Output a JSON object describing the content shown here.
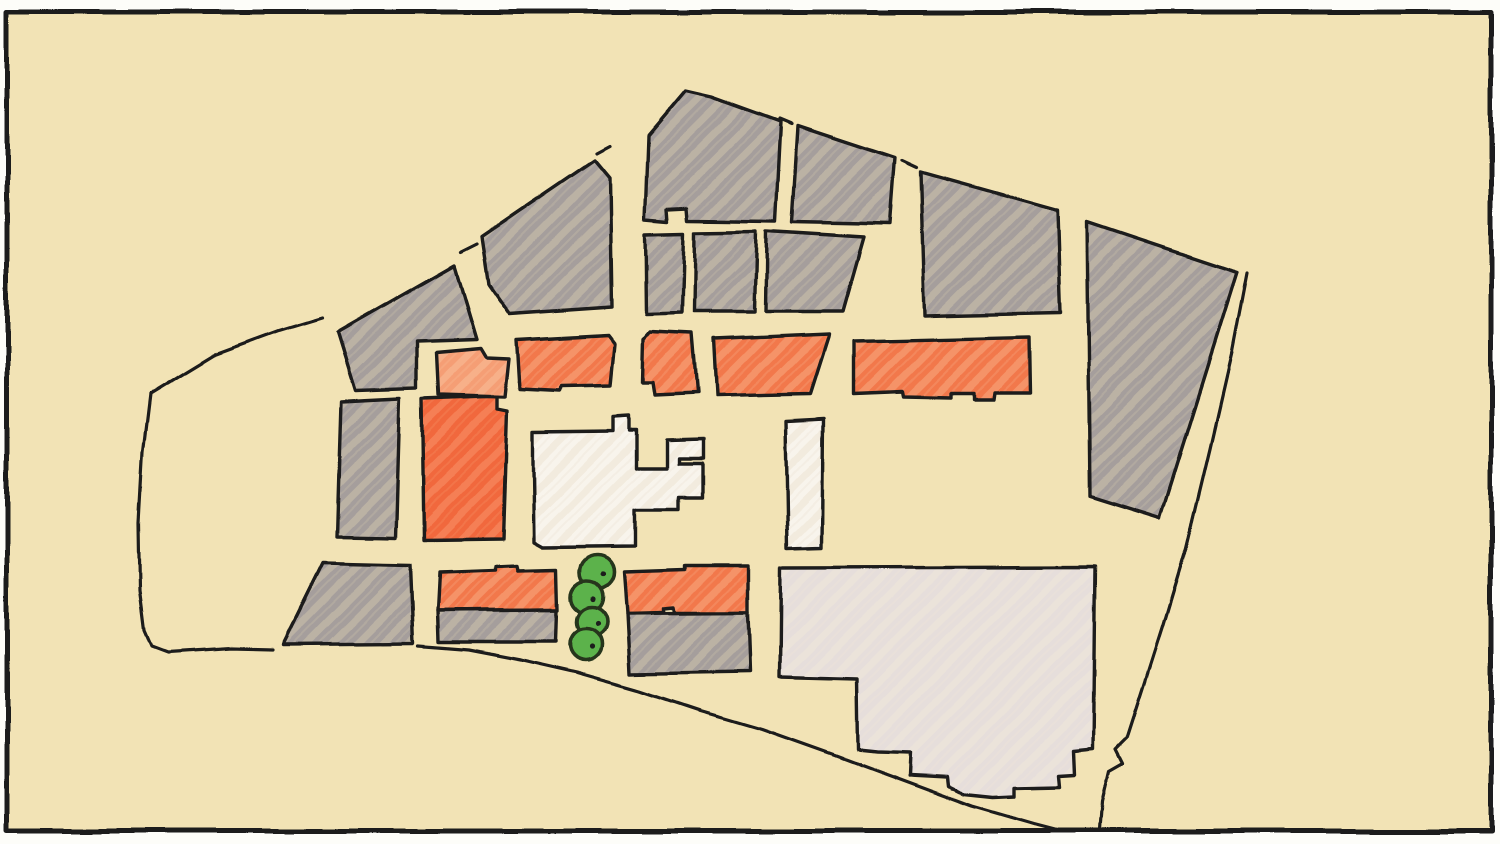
{
  "canvas": {
    "width": 1500,
    "height": 844,
    "frame": {
      "x": 7,
      "y": 12,
      "width": 1484,
      "height": 819
    }
  },
  "palette": {
    "paper": "#fdfdf9",
    "canvas_fill": "#f2e3b5",
    "ink": "#1d1c1a",
    "tree_outline": "#26351d",
    "fills": {
      "gray": {
        "base": "#a59e9c",
        "streak": "#cdc3ab"
      },
      "orange": {
        "base": "#f2784c",
        "streak": "#f8a97e"
      },
      "orange_light": {
        "base": "#f59e74",
        "streak": "#f9bf9a"
      },
      "orange_strong": {
        "base": "#f1673c",
        "streak": "#f79468"
      },
      "white": {
        "base": "#f8f4ec",
        "streak": "#ece4d2"
      },
      "lavender": {
        "base": "#e6dedb",
        "streak": "#efe7d9"
      },
      "tree": {
        "base": "#5cb24b",
        "streak": "#5cb24b"
      }
    }
  },
  "map": {
    "blocks": [
      {
        "name": "gray-block-west-upper",
        "category": "gray",
        "points": [
          [
            338,
            332
          ],
          [
            455,
            265
          ],
          [
            477,
            339
          ],
          [
            416,
            341
          ],
          [
            416,
            388
          ],
          [
            356,
            390
          ]
        ]
      },
      {
        "name": "gray-block-northwest",
        "category": "gray",
        "points": [
          [
            482,
            237
          ],
          [
            595,
            160
          ],
          [
            610,
            178
          ],
          [
            612,
            307
          ],
          [
            510,
            314
          ],
          [
            489,
            284
          ]
        ]
      },
      {
        "name": "gray-block-north-peak",
        "category": "gray",
        "points": [
          [
            648,
            136
          ],
          [
            686,
            91
          ],
          [
            712,
            97
          ],
          [
            781,
            122
          ],
          [
            776,
            221
          ],
          [
            688,
            220
          ],
          [
            687,
            208
          ],
          [
            667,
            209
          ],
          [
            668,
            221
          ],
          [
            645,
            219
          ]
        ]
      },
      {
        "name": "gray-block-north-mid",
        "category": "gray",
        "points": [
          [
            798,
            126
          ],
          [
            895,
            158
          ],
          [
            890,
            224
          ],
          [
            792,
            222
          ]
        ]
      },
      {
        "name": "gray-block-northeast",
        "category": "gray",
        "points": [
          [
            921,
            172
          ],
          [
            1057,
            210
          ],
          [
            1060,
            313
          ],
          [
            925,
            316
          ]
        ]
      },
      {
        "name": "gray-block-row2-a",
        "category": "gray",
        "points": [
          [
            645,
            234
          ],
          [
            684,
            233
          ],
          [
            682,
            313
          ],
          [
            646,
            314
          ]
        ]
      },
      {
        "name": "gray-block-row2-b",
        "category": "gray",
        "points": [
          [
            695,
            232
          ],
          [
            757,
            231
          ],
          [
            755,
            312
          ],
          [
            694,
            312
          ]
        ]
      },
      {
        "name": "gray-block-row2-c",
        "category": "gray",
        "points": [
          [
            767,
            231
          ],
          [
            864,
            237
          ],
          [
            843,
            311
          ],
          [
            766,
            311
          ]
        ]
      },
      {
        "name": "gray-block-east-wedge",
        "category": "gray",
        "points": [
          [
            1087,
            222
          ],
          [
            1237,
            272
          ],
          [
            1160,
            518
          ],
          [
            1090,
            496
          ]
        ]
      },
      {
        "name": "gray-strip-mid-west",
        "category": "gray",
        "points": [
          [
            341,
            401
          ],
          [
            400,
            398
          ],
          [
            396,
            537
          ],
          [
            337,
            536
          ]
        ]
      },
      {
        "name": "orange-tower-mid-west",
        "category": "orange_strong",
        "points": [
          [
            422,
            399
          ],
          [
            497,
            396
          ],
          [
            497,
            409
          ],
          [
            507,
            411
          ],
          [
            503,
            539
          ],
          [
            424,
            540
          ]
        ]
      },
      {
        "name": "orange-block-row1-1",
        "category": "orange_light",
        "points": [
          [
            436,
            352
          ],
          [
            481,
            348
          ],
          [
            487,
            358
          ],
          [
            509,
            359
          ],
          [
            505,
            397
          ],
          [
            438,
            395
          ]
        ]
      },
      {
        "name": "orange-block-row1-2",
        "category": "orange",
        "points": [
          [
            517,
            340
          ],
          [
            608,
            335
          ],
          [
            615,
            344
          ],
          [
            611,
            385
          ],
          [
            562,
            386
          ],
          [
            560,
            391
          ],
          [
            520,
            389
          ]
        ]
      },
      {
        "name": "orange-block-row1-3",
        "category": "orange",
        "points": [
          [
            644,
            339
          ],
          [
            650,
            332
          ],
          [
            692,
            334
          ],
          [
            697,
            393
          ],
          [
            655,
            395
          ],
          [
            653,
            382
          ],
          [
            643,
            382
          ]
        ]
      },
      {
        "name": "orange-block-row1-4",
        "category": "orange",
        "points": [
          [
            713,
            339
          ],
          [
            829,
            334
          ],
          [
            810,
            394
          ],
          [
            716,
            396
          ]
        ]
      },
      {
        "name": "orange-block-row1-5",
        "category": "orange",
        "points": [
          [
            854,
            341
          ],
          [
            1029,
            337
          ],
          [
            1030,
            393
          ],
          [
            994,
            393
          ],
          [
            993,
            400
          ],
          [
            973,
            400
          ],
          [
            973,
            394
          ],
          [
            950,
            394
          ],
          [
            950,
            398
          ],
          [
            903,
            397
          ],
          [
            902,
            392
          ],
          [
            854,
            394
          ]
        ]
      },
      {
        "name": "white-building-main",
        "category": "white",
        "points": [
          [
            533,
            432
          ],
          [
            613,
            431
          ],
          [
            613,
            417
          ],
          [
            629,
            416
          ],
          [
            629,
            431
          ],
          [
            636,
            431
          ],
          [
            636,
            468
          ],
          [
            667,
            468
          ],
          [
            667,
            440
          ],
          [
            703,
            439
          ],
          [
            703,
            458
          ],
          [
            679,
            458
          ],
          [
            679,
            463
          ],
          [
            702,
            463
          ],
          [
            702,
            498
          ],
          [
            678,
            498
          ],
          [
            678,
            510
          ],
          [
            635,
            510
          ],
          [
            635,
            546
          ],
          [
            543,
            547
          ],
          [
            534,
            542
          ],
          [
            533,
            470
          ]
        ]
      },
      {
        "name": "white-building-bar",
        "category": "white",
        "points": [
          [
            786,
            421
          ],
          [
            823,
            419
          ],
          [
            822,
            547
          ],
          [
            788,
            548
          ]
        ]
      },
      {
        "name": "gray-block-southwest",
        "category": "gray",
        "points": [
          [
            323,
            563
          ],
          [
            410,
            565
          ],
          [
            413,
            643
          ],
          [
            283,
            644
          ]
        ]
      },
      {
        "name": "orange-block-south-a",
        "category": "orange",
        "points": [
          [
            439,
            573
          ],
          [
            496,
            571
          ],
          [
            496,
            567
          ],
          [
            517,
            566
          ],
          [
            518,
            571
          ],
          [
            557,
            570
          ],
          [
            558,
            610
          ],
          [
            437,
            611
          ]
        ]
      },
      {
        "name": "gray-base-south-a",
        "category": "gray",
        "points": [
          [
            437,
            611
          ],
          [
            557,
            610
          ],
          [
            556,
            642
          ],
          [
            438,
            642
          ]
        ]
      },
      {
        "name": "orange-block-south-b",
        "category": "orange",
        "points": [
          [
            624,
            572
          ],
          [
            684,
            570
          ],
          [
            684,
            566
          ],
          [
            748,
            566
          ],
          [
            748,
            612
          ],
          [
            674,
            612
          ],
          [
            673,
            607
          ],
          [
            663,
            608
          ],
          [
            663,
            612
          ],
          [
            627,
            613
          ]
        ]
      },
      {
        "name": "gray-base-south-b",
        "category": "gray",
        "points": [
          [
            627,
            613
          ],
          [
            748,
            612
          ],
          [
            750,
            672
          ],
          [
            630,
            674
          ]
        ]
      },
      {
        "name": "lavender-building-large",
        "category": "lavender",
        "points": [
          [
            781,
            568
          ],
          [
            1095,
            567
          ],
          [
            1093,
            749
          ],
          [
            1073,
            751
          ],
          [
            1074,
            774
          ],
          [
            1058,
            775
          ],
          [
            1059,
            786
          ],
          [
            1015,
            787
          ],
          [
            1015,
            796
          ],
          [
            993,
            797
          ],
          [
            964,
            794
          ],
          [
            948,
            786
          ],
          [
            947,
            777
          ],
          [
            909,
            775
          ],
          [
            910,
            752
          ],
          [
            877,
            751
          ],
          [
            858,
            749
          ],
          [
            857,
            679
          ],
          [
            780,
            677
          ]
        ]
      }
    ],
    "boundary_segments": [
      {
        "name": "west-boundary",
        "points": [
          [
            150,
            394
          ],
          [
            143,
            452
          ],
          [
            139,
            522
          ],
          [
            140,
            590
          ],
          [
            145,
            630
          ],
          [
            152,
            646
          ],
          [
            168,
            652
          ],
          [
            230,
            648
          ],
          [
            272,
            649
          ]
        ]
      },
      {
        "name": "northwest-boundary",
        "points": [
          [
            150,
            394
          ],
          [
            214,
            355
          ],
          [
            279,
            331
          ],
          [
            322,
            318
          ]
        ]
      },
      {
        "name": "boundary-dash-1",
        "points": [
          [
            461,
            252
          ],
          [
            477,
            244
          ]
        ]
      },
      {
        "name": "boundary-dash-2",
        "points": [
          [
            597,
            153
          ],
          [
            610,
            146
          ]
        ]
      },
      {
        "name": "boundary-dash-3",
        "points": [
          [
            780,
            119
          ],
          [
            792,
            124
          ]
        ]
      },
      {
        "name": "boundary-dash-4",
        "points": [
          [
            902,
            161
          ],
          [
            917,
            168
          ]
        ]
      },
      {
        "name": "east-boundary",
        "points": [
          [
            1247,
            273
          ],
          [
            1232,
            352
          ],
          [
            1210,
            448
          ],
          [
            1186,
            548
          ],
          [
            1163,
            625
          ],
          [
            1143,
            688
          ],
          [
            1127,
            738
          ],
          [
            1116,
            749
          ],
          [
            1123,
            763
          ],
          [
            1109,
            771
          ],
          [
            1102,
            801
          ],
          [
            1100,
            830
          ]
        ]
      }
    ],
    "road_segments": [
      {
        "name": "south-road",
        "points": [
          [
            418,
            646
          ],
          [
            468,
            650
          ],
          [
            520,
            660
          ],
          [
            577,
            673
          ],
          [
            640,
            691
          ],
          [
            700,
            711
          ],
          [
            762,
            729
          ],
          [
            832,
            754
          ],
          [
            902,
            780
          ],
          [
            972,
            806
          ],
          [
            1034,
            824
          ],
          [
            1057,
            830
          ]
        ]
      }
    ],
    "trees": [
      {
        "cx": 597,
        "cy": 572,
        "r": 17
      },
      {
        "cx": 587,
        "cy": 597,
        "r": 16
      },
      {
        "cx": 592,
        "cy": 622,
        "r": 15
      },
      {
        "cx": 586,
        "cy": 645,
        "r": 16
      }
    ]
  }
}
